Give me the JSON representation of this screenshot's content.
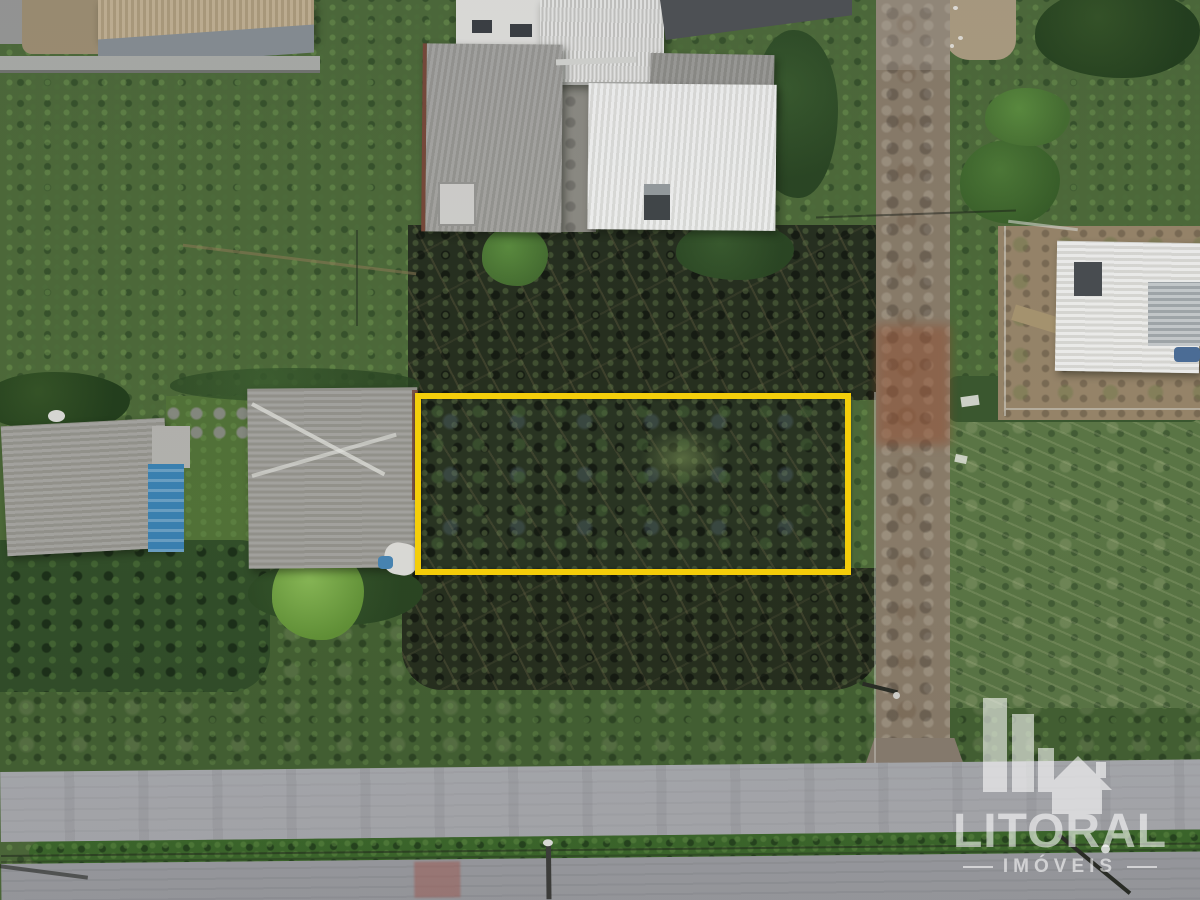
{
  "watermark": {
    "brand": "LITORAL",
    "subtitle": "IMÓVEIS"
  },
  "colors": {
    "lot-outline": "#ffd60a",
    "watermark": "#ffffff"
  }
}
